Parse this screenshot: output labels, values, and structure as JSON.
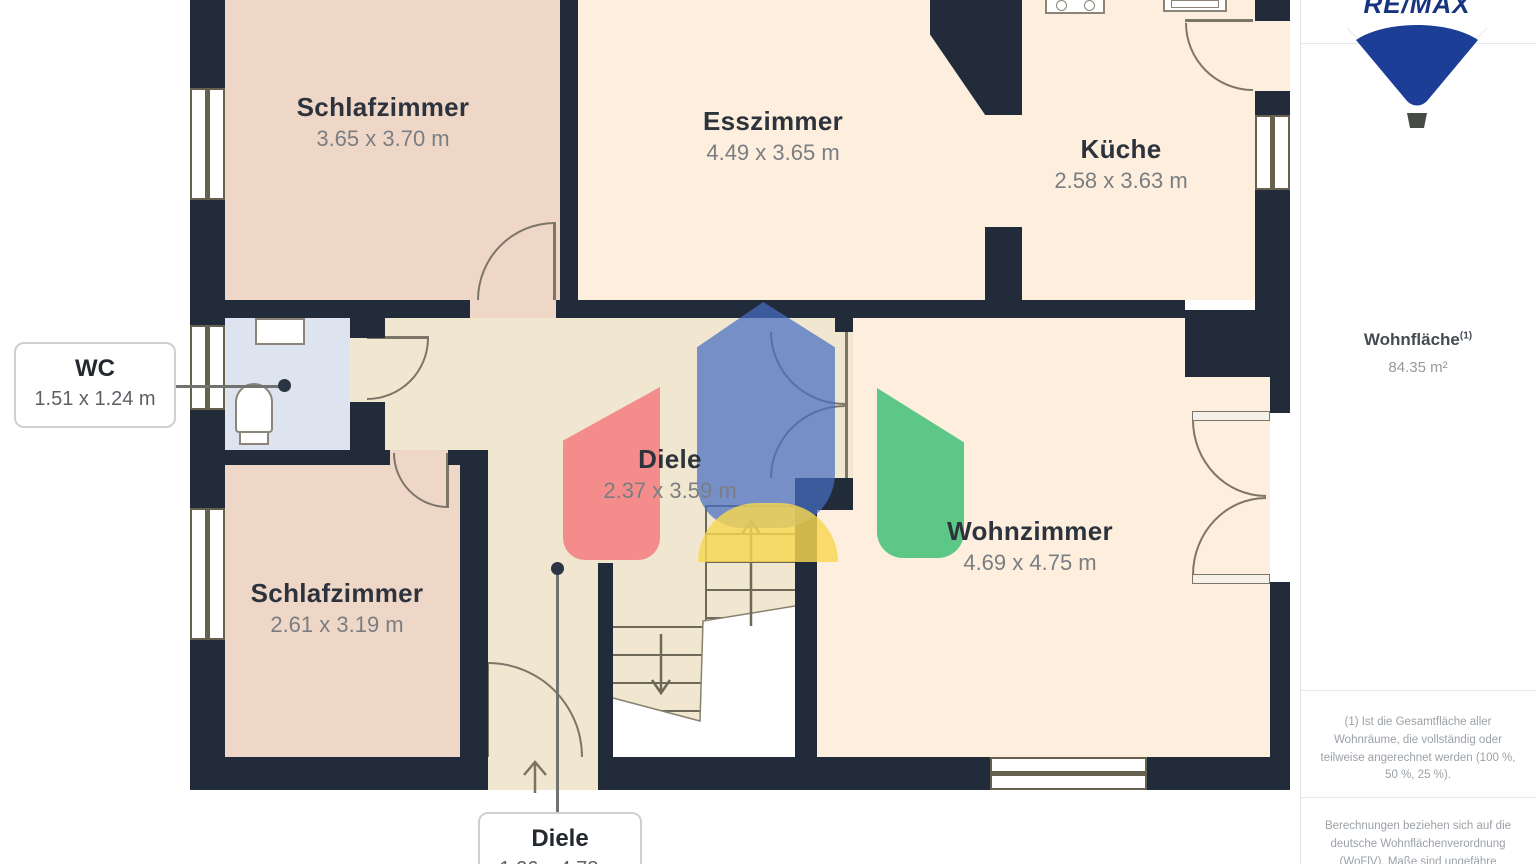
{
  "plan": {
    "rooms": [
      {
        "name": "Schlafzimmer",
        "dims": "3.65 x 3.70 m"
      },
      {
        "name": "Esszimmer",
        "dims": "4.49 x 3.65 m"
      },
      {
        "name": "Küche",
        "dims": "2.58 x 3.63 m"
      },
      {
        "name": "Diele",
        "dims": "2.37 x 3.59 m"
      },
      {
        "name": "Wohnzimmer",
        "dims": "4.69 x 4.75 m"
      },
      {
        "name": "Schlafzimmer",
        "dims": "2.61 x 3.19 m"
      }
    ],
    "callouts": {
      "wc": {
        "name": "WC",
        "dims": "1.51 x 1.24 m"
      },
      "diele": {
        "name": "Diele",
        "dims": "1.26 x 4.78 m"
      }
    }
  },
  "sidebar": {
    "brand": "RE/MAX",
    "area": {
      "label": "Wohnfläche",
      "sup": "(1)",
      "value": "84.35 m²"
    },
    "footnotes": [
      "(1) Ist die Gesamtfläche aller Wohnräume, die vollständig oder teilweise angerechnet werden (100 %, 50 %, 25 %).",
      "Berechnungen beziehen sich auf die deutsche Wohnflächenverordnung (WoFlV). Maße sind ungefähre Angaben"
    ]
  },
  "colors": {
    "wall": "#222b3a",
    "room_cream": "#fdeedd",
    "hall": "#f1e7d0",
    "bedroom_pink": "#efd7c8",
    "wc_blue": "#dee4ef",
    "watermark_blue": "#4a6ec3",
    "watermark_red": "#f2707a",
    "watermark_green": "#38be73",
    "watermark_yellow": "#f6d750",
    "brand_blue": "#1d3e96"
  }
}
